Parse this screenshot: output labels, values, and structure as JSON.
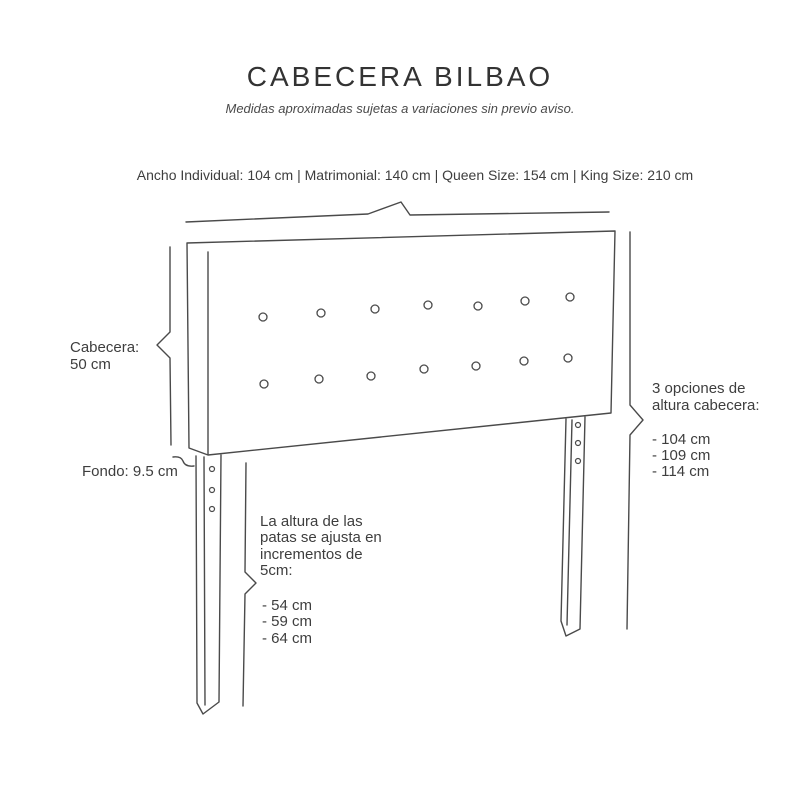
{
  "page": {
    "title": "CABECERA BILBAO",
    "subtitle": "Medidas aproximadas sujetas a variaciones sin previo aviso."
  },
  "diagram": {
    "width_options_label": "Ancho Individual: 104 cm | Matrimonial: 140 cm | Queen Size: 154 cm | King Size: 210 cm",
    "headboard_height_label": "Cabecera:\n50 cm",
    "depth_label": "Fondo: 9.5 cm",
    "height_options_title": "3 opciones de\naltura cabecera:",
    "height_options_list": "- 104 cm\n- 109 cm\n- 114 cm",
    "leg_adjust_title": "La altura de las\npatas se ajusta en\nincrementos de\n5cm:",
    "leg_adjust_list": "- 54 cm\n- 59 cm\n- 64 cm",
    "colors": {
      "line": "#4a4a4a",
      "text": "#3e3e3e",
      "background": "#ffffff"
    }
  }
}
